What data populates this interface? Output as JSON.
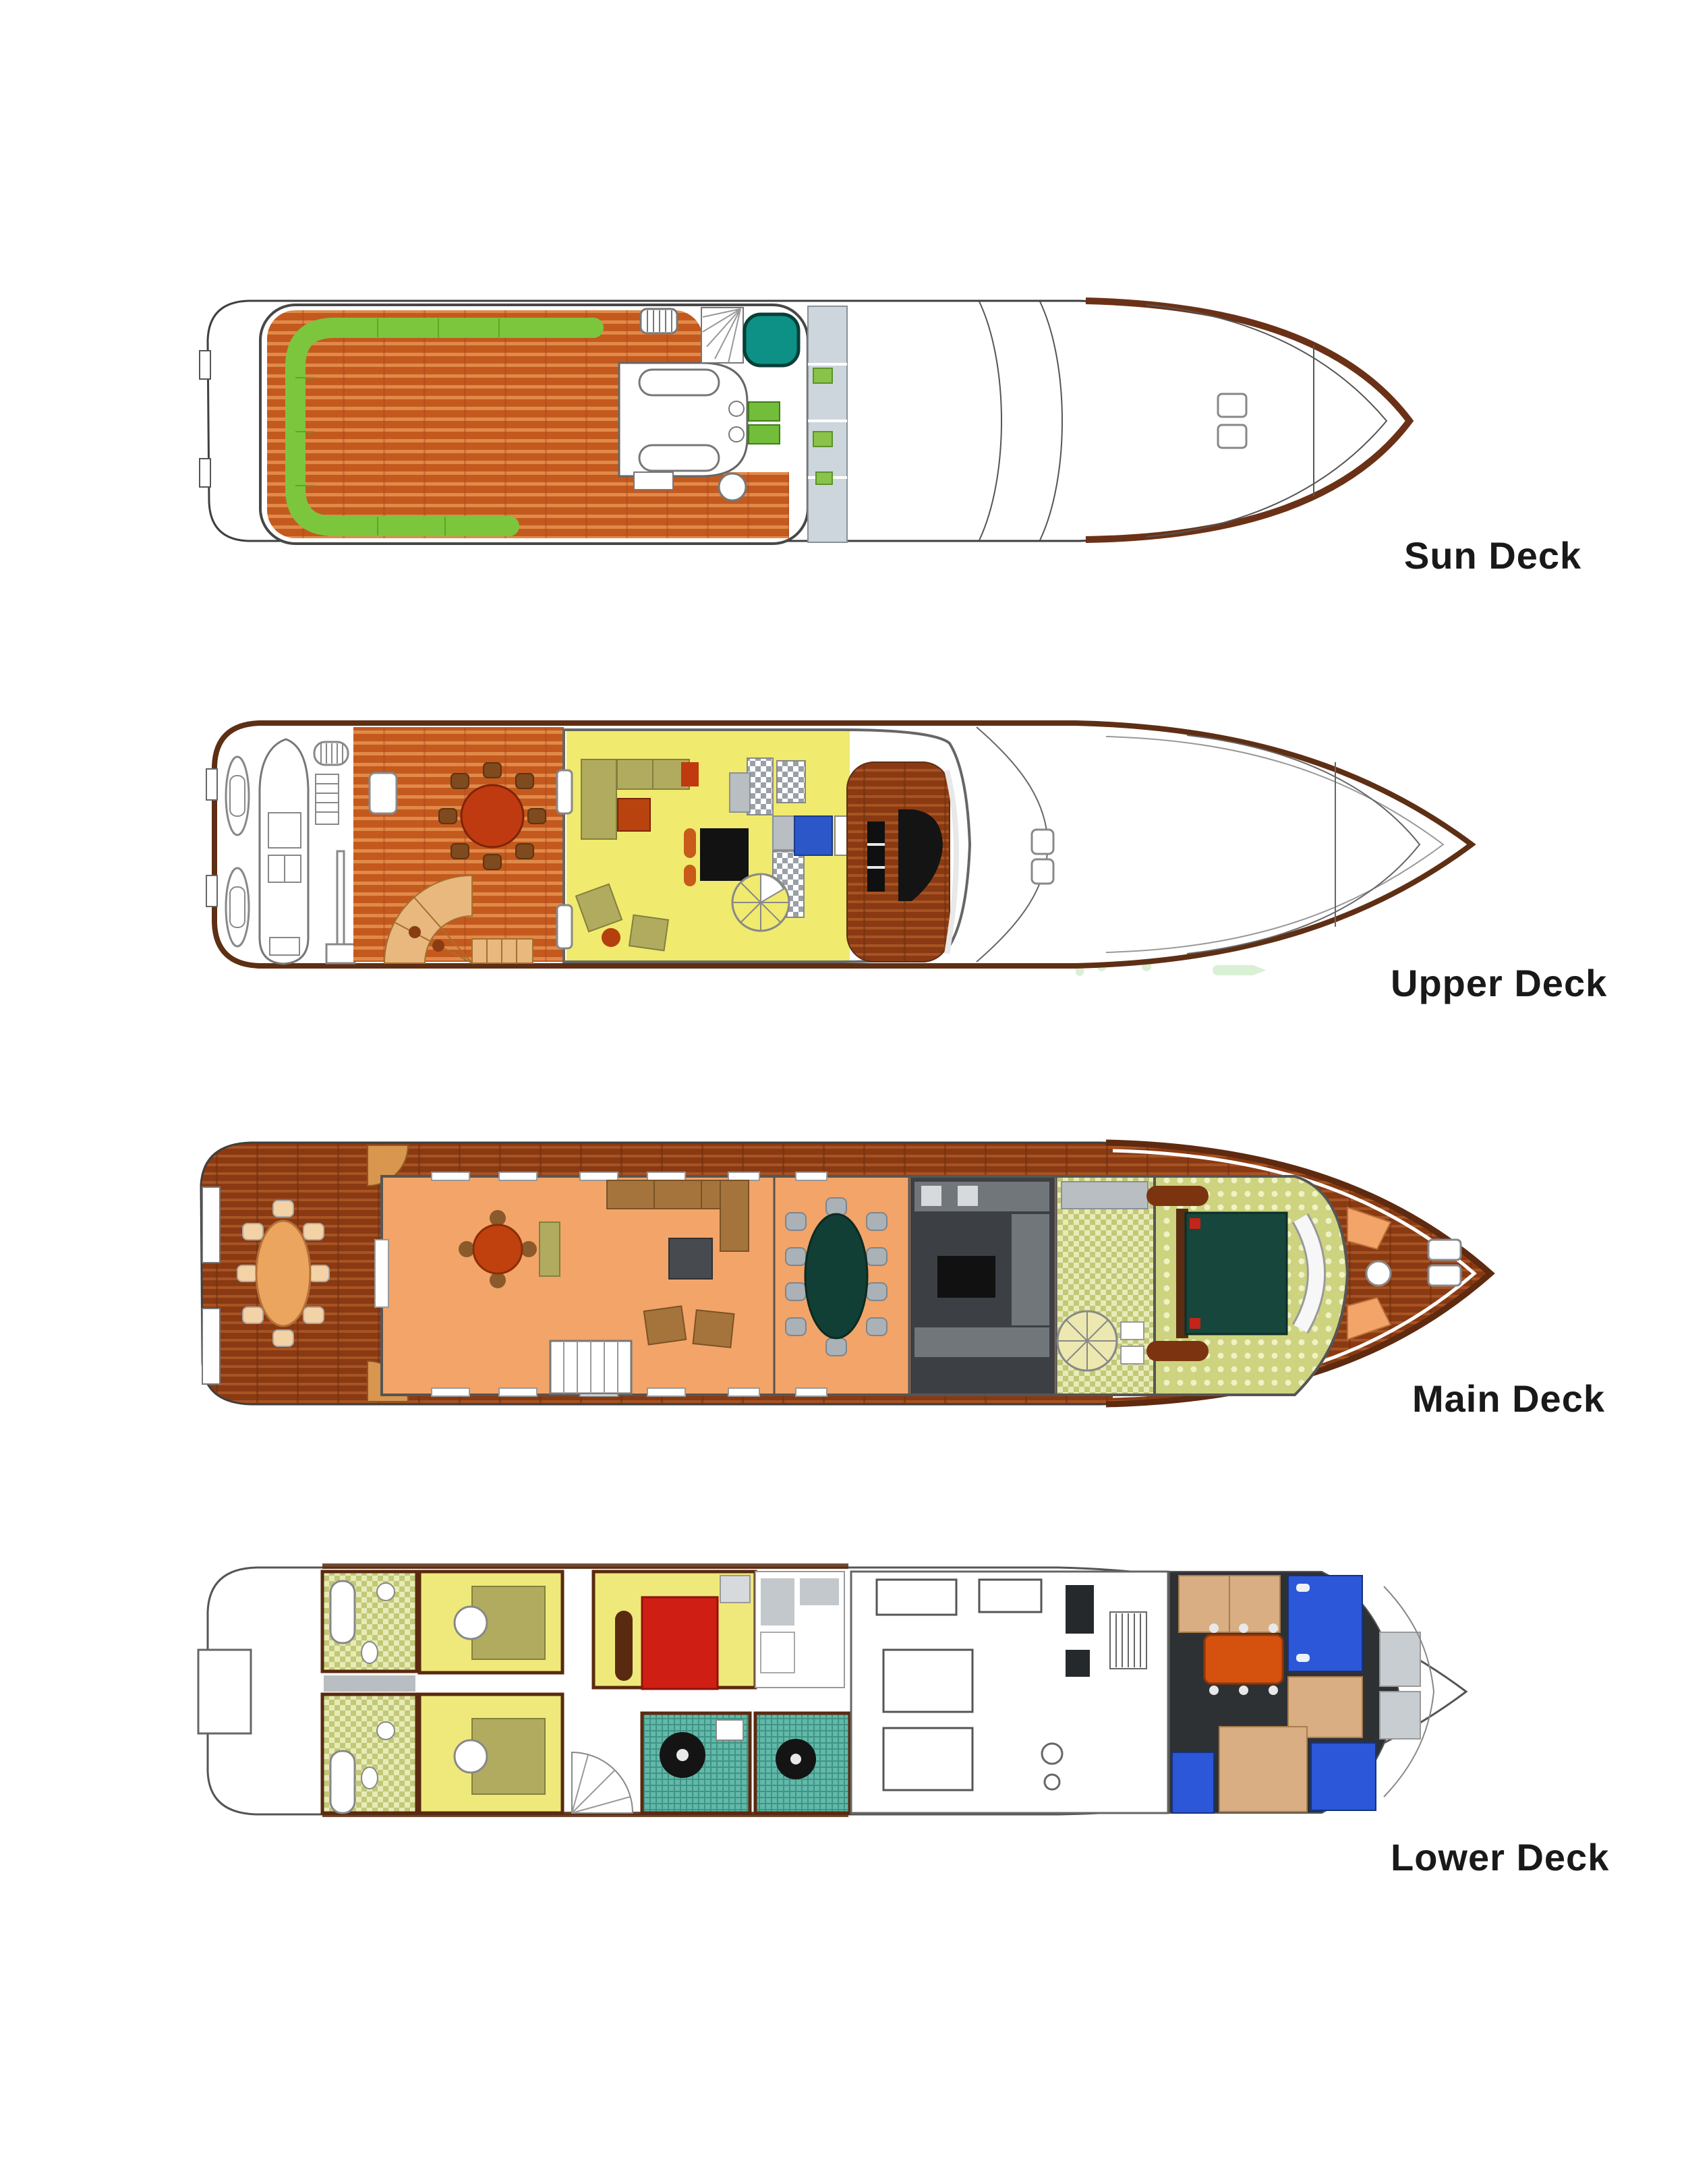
{
  "page_title": "Yacht deck plans",
  "decks": [
    {
      "id": "sun-deck",
      "label": "Sun Deck"
    },
    {
      "id": "upper-deck",
      "label": "Upper Deck"
    },
    {
      "id": "main-deck",
      "label": "Main Deck"
    },
    {
      "id": "lower-deck",
      "label": "Lower Deck"
    }
  ],
  "watermark": {
    "text": "IME",
    "color": "#daf0d5"
  },
  "colors": {
    "background": "#ffffff",
    "label_text": "#191919",
    "teak_deck": "#c4591e",
    "teak_stripe": "#e08a4a",
    "dark_teak": "#8a3a12",
    "hull_outline": "#3f3f3f",
    "bow_rail_brown": "#5e2a10",
    "sunpad_green": "#7cc63e",
    "jacuzzi_teal": "#0d9186",
    "salon_yellow": "#f0ea6e",
    "olive_sofa": "#b0ab5e",
    "table_red": "#bf3a10",
    "salon_peach": "#f3a469",
    "dining_teal": "#123f35",
    "galley_charcoal": "#3c3f43",
    "master_floor": "#cdd37e",
    "master_bed_teal": "#16463c",
    "pillow_red": "#c3251a",
    "cabin_yellow": "#efe97b",
    "vip_bed_red": "#cf1f14",
    "bath_tile_teal": "#63b9a9",
    "crew_floor": "#2e3134",
    "crew_bed_blue": "#2b57d8",
    "crew_bunk_tan": "#d8ae82",
    "crew_table_orange": "#d4520e"
  }
}
